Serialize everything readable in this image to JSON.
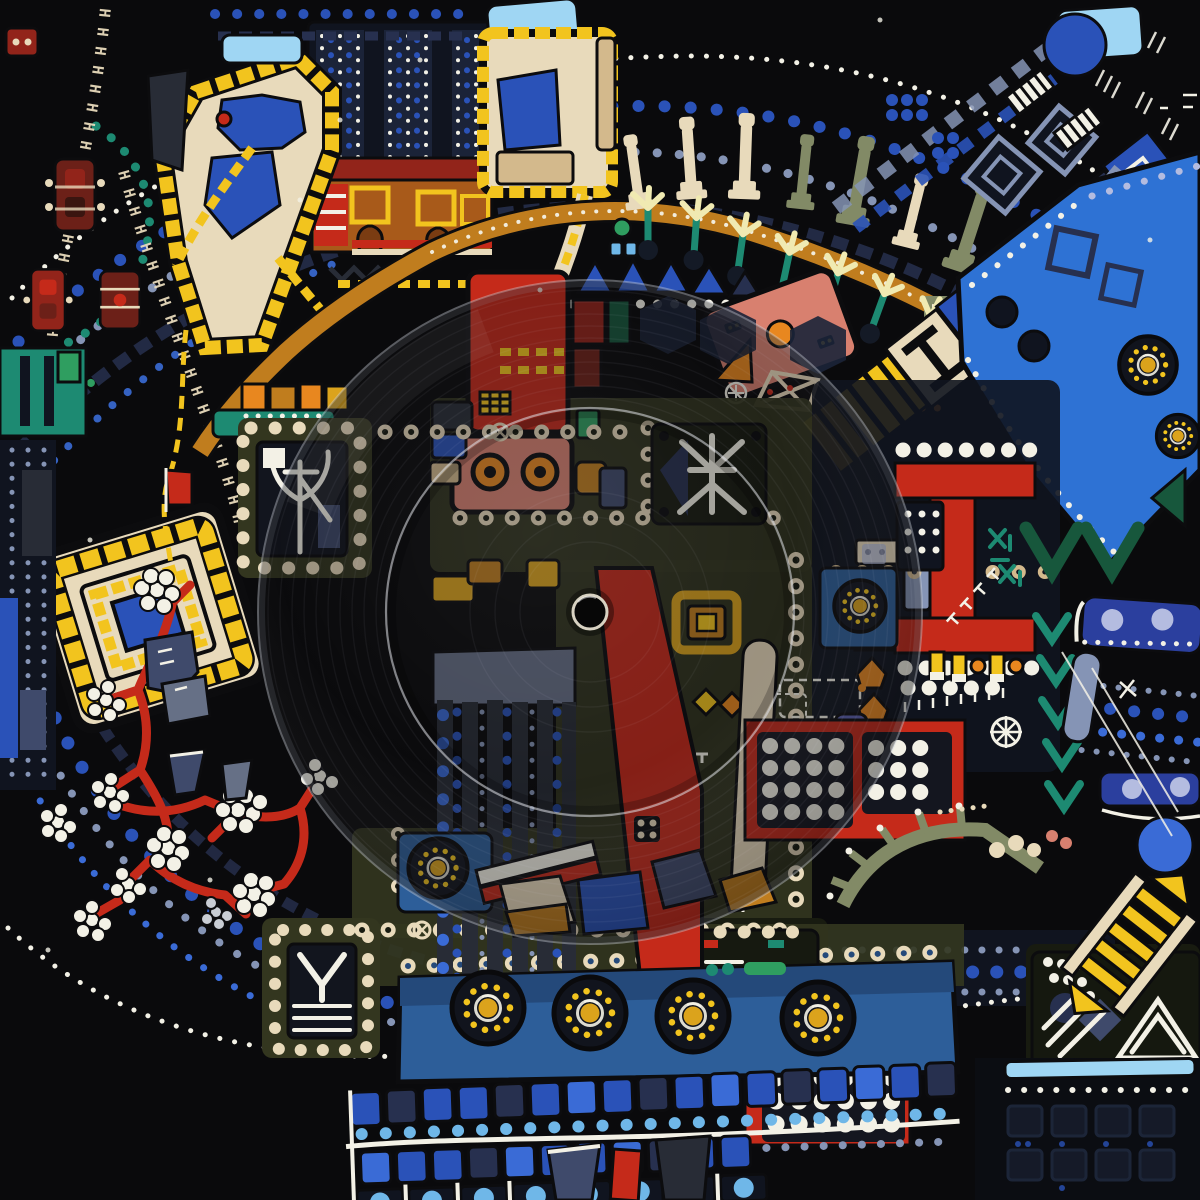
{
  "artwork": {
    "kind": "record-sleeve",
    "description": "Abstract geometric folk-art painting in blues, reds, yellows and cream on black, covered by a clear vinyl record with visible groove rings and centre hole",
    "background": "#0a0a0c",
    "h_chain_text": "HHHHHHHHHHHHHHHHHHHH",
    "h_chain_text_2": "HHHHHHHHHHHHHHHHHHHH"
  },
  "palette": {
    "bg": "#0a0a0c",
    "ink": "#0c0c0e",
    "navy": "#1b2338",
    "navy2": "#27304f",
    "dknavy": "#10141f",
    "slate": "#3f4a6b",
    "steel": "#8594b5",
    "royal": "#2a52b8",
    "blue": "#3a6bd6",
    "band": "#2e72d4",
    "skyblue": "#6fb7e8",
    "powder": "#9fd6f3",
    "lav": "#b4bce0",
    "teal": "#1d8a72",
    "green": "#2f9e60",
    "ltgreen": "#82d4a0",
    "dkgreen": "#17573c",
    "olive": "#33361f",
    "panel": "#181b10",
    "sage": "#828a66",
    "cream": "#e8dabb",
    "tan": "#d3b98c",
    "white": "#f3f1e6",
    "yellow": "#f2c41e",
    "gold": "#dba31c",
    "amber": "#c07d1e",
    "orange": "#e8871f",
    "red": "#c52a1a",
    "dkred": "#92241a",
    "maroon": "#6c2018",
    "salmon": "#d8806f",
    "pink": "#ec9f94",
    "rose": "#c5646a",
    "charcoal": "#282c36",
    "gray": "#667086",
    "ltgray": "#b3bac6",
    "bluepanel": "#2d5e99",
    "royal2": "#2b3f9e",
    "violet": "#5a5fae"
  },
  "vinyl": {
    "center_x": 590,
    "center_y": 612,
    "outer_radius": 332,
    "groove_ring_radius": 204,
    "hole_radius": 17
  },
  "motifs": {
    "rosettes": 8,
    "telegraph_poles": 9,
    "sprig_trees": 7,
    "white_dot_clusters": 11,
    "h_bead_chains": 2,
    "glyph_panels": [
      "antlers",
      "branch-figure",
      "cat-whiskers",
      "triangle-slash",
      "triangle-lines"
    ],
    "dot_arc_systems": [
      "upper-left sweep",
      "lower-left sweep",
      "top-right sweep",
      "bottom-right rows"
    ]
  }
}
